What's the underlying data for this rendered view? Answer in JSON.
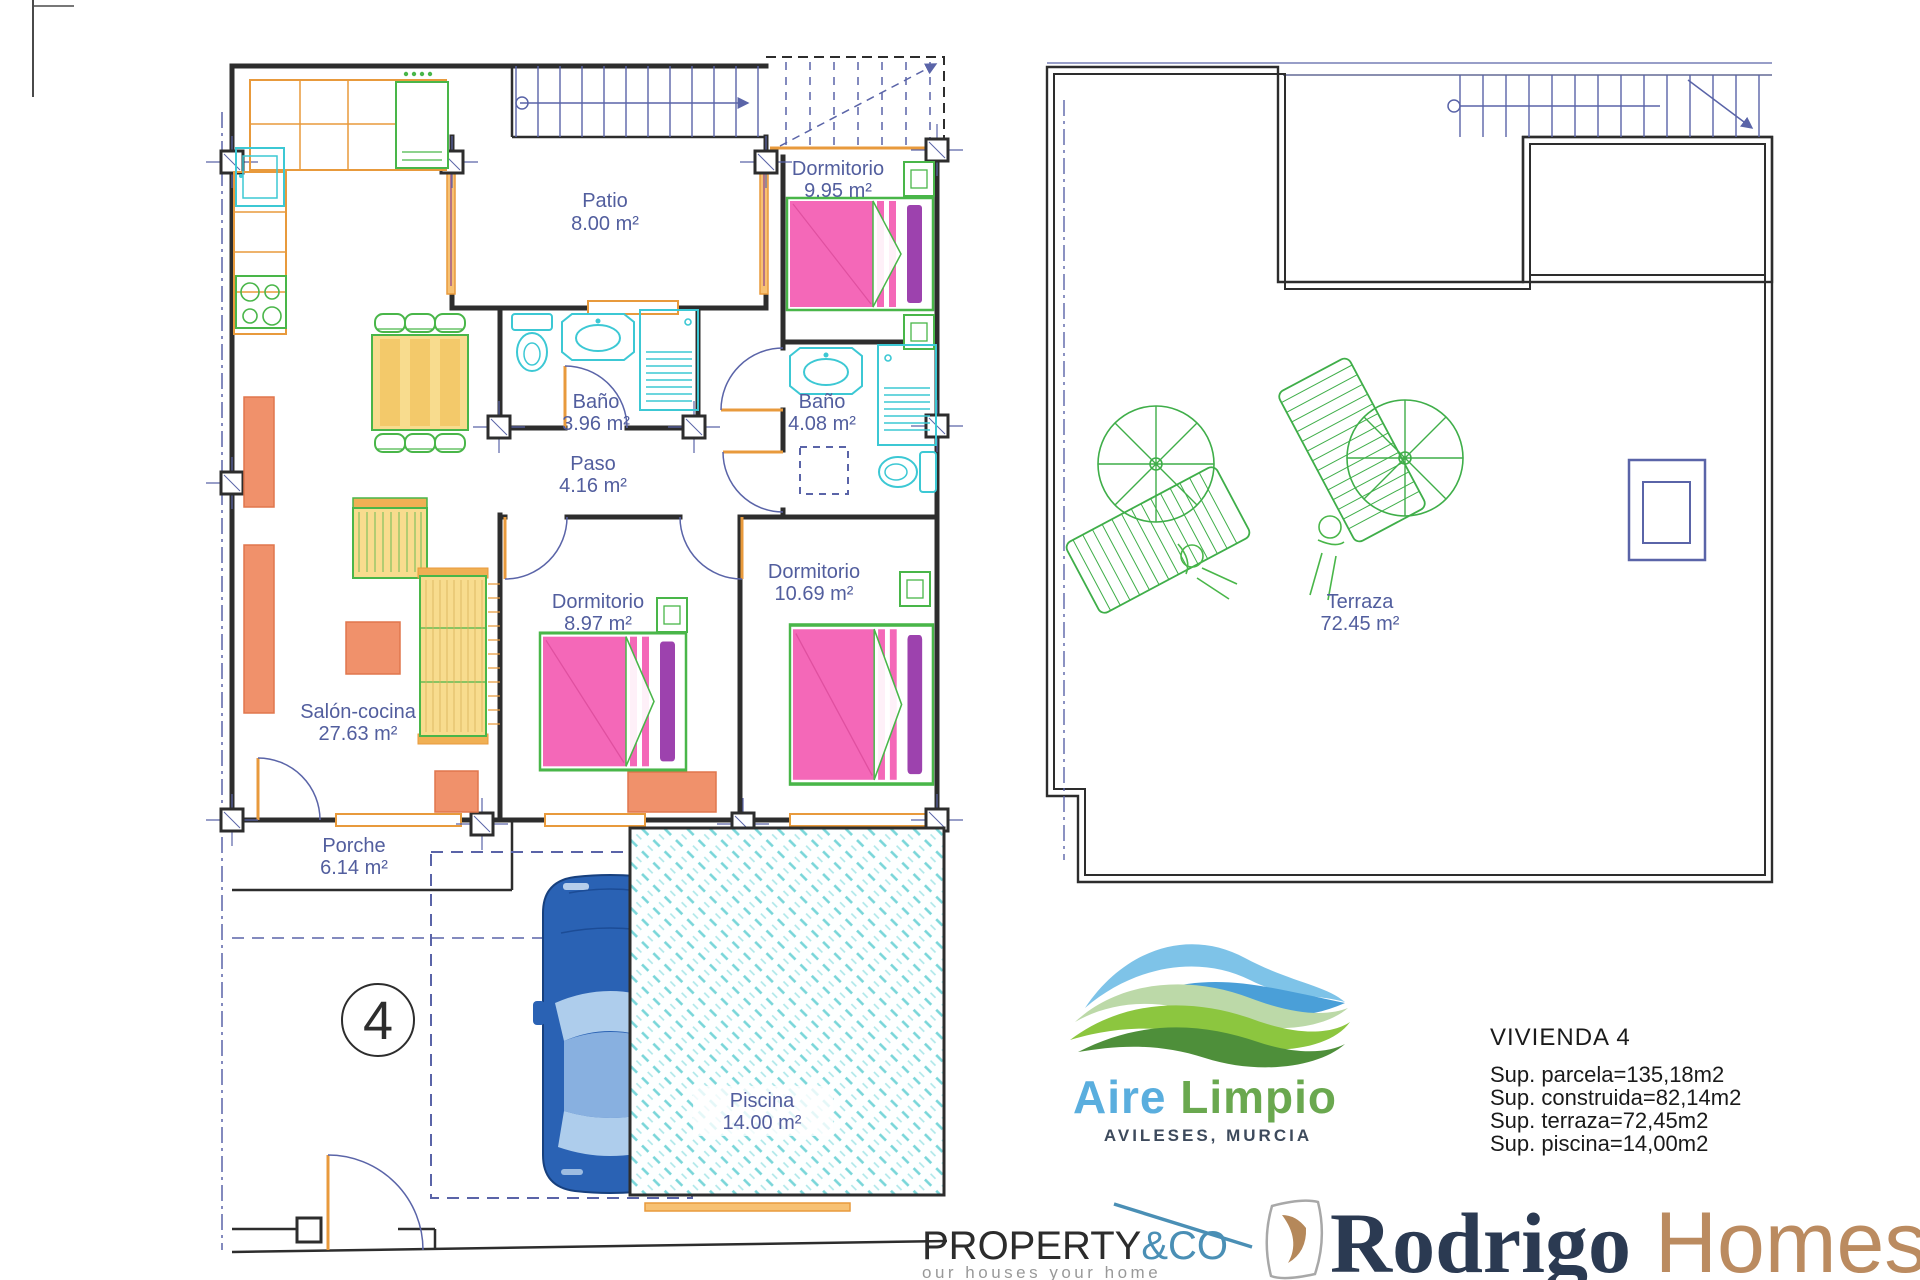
{
  "plan": {
    "unit_number": "4",
    "rooms": {
      "patio": {
        "name": "Patio",
        "area": "8.00 m²"
      },
      "dormitorio1": {
        "name": "Dormitorio",
        "area": "9.95 m²"
      },
      "bano1": {
        "name": "Baño",
        "area": "3.96 m²"
      },
      "bano2": {
        "name": "Baño",
        "area": "4.08 m²"
      },
      "paso": {
        "name": "Paso",
        "area": "4.16 m²"
      },
      "dormitorio2": {
        "name": "Dormitorio",
        "area": "8.97 m²"
      },
      "dormitorio3": {
        "name": "Dormitorio",
        "area": "10.69 m²"
      },
      "salon": {
        "name": "Salón-cocina",
        "area": "27.63 m²"
      },
      "porche": {
        "name": "Porche",
        "area": "6.14 m²"
      },
      "piscina": {
        "name": "Piscina",
        "area": "14.00 m²"
      },
      "terraza": {
        "name": "Terraza",
        "area": "72.45 m²"
      }
    }
  },
  "info": {
    "title": "VIVIENDA 4",
    "lines": [
      "Sup. parcela=135,18m2",
      "Sup. construida=82,14m2",
      "Sup. terraza=72,45m2",
      "Sup. piscina=14,00m2"
    ]
  },
  "logos": {
    "aire_limpio": {
      "name_blue": "Aire",
      "name_green": " Limpio",
      "location": "AVILESES, MURCIA"
    },
    "property_co": {
      "name_dark": "PROPERTY",
      "name_blue": "&CO",
      "tagline": "our houses your home"
    },
    "rodrigo_homes": {
      "name_serif": "Rodrigo",
      "name_sans": " Homes"
    }
  },
  "colors": {
    "accent_blue": "#4a8fb5",
    "plan_label_blue": "#525e9e",
    "wave_green": "#8cc63f",
    "wave_blue": "#58a8d8",
    "brand_navy": "#2b3a52",
    "brand_tan": "#b5885a",
    "pool_teal": "#79d6d9",
    "bed_pink": "#f468b8",
    "car_blue": "#2a62b4"
  }
}
